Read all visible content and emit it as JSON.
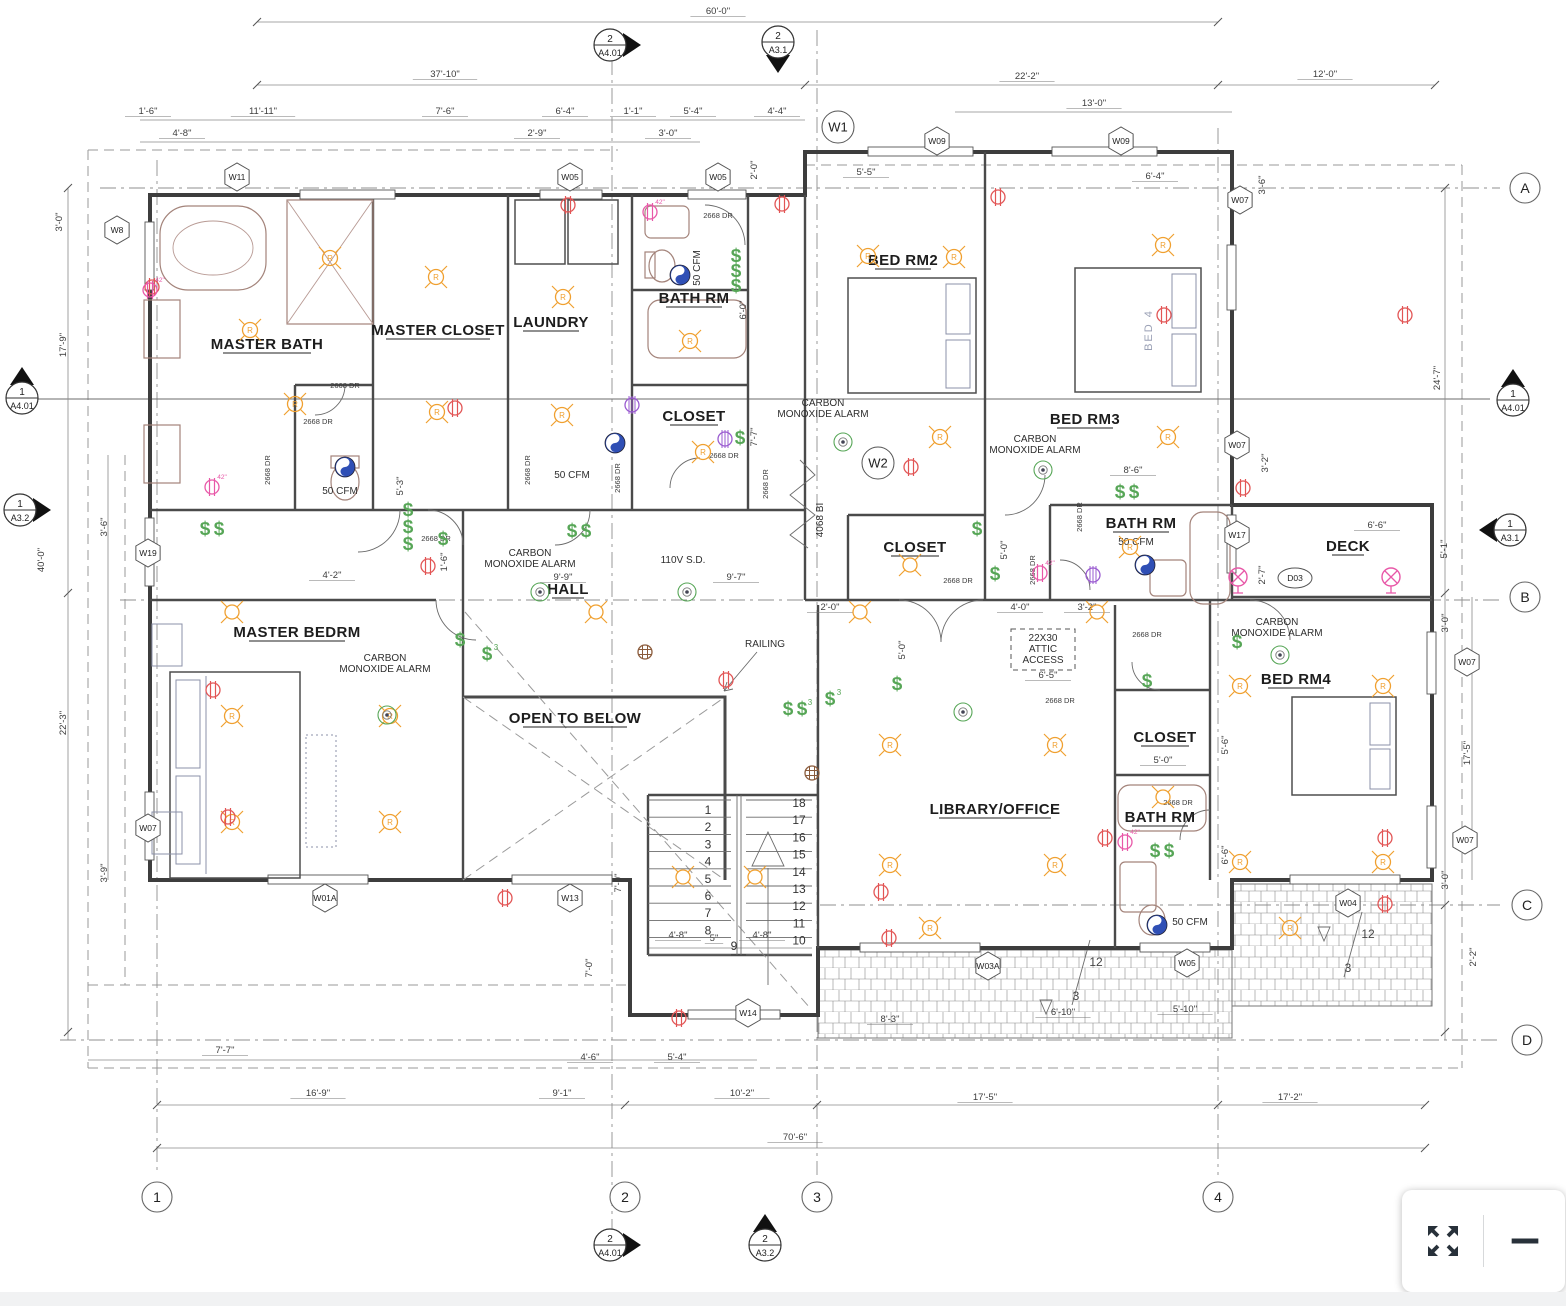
{
  "toolbar": {
    "fullscreen_label": "fullscreen",
    "zoom_out_label": "zoom out"
  },
  "plan": {
    "rooms": [
      {
        "label": "MASTER BATH",
        "x": 267,
        "y": 349
      },
      {
        "label": "MASTER CLOSET",
        "x": 438,
        "y": 335
      },
      {
        "label": "LAUNDRY",
        "x": 551,
        "y": 327
      },
      {
        "label": "BATH RM",
        "x": 694,
        "y": 303
      },
      {
        "label": "BED RM2",
        "x": 903,
        "y": 265
      },
      {
        "label": "BED RM3",
        "x": 1085,
        "y": 424
      },
      {
        "label": "CLOSET",
        "x": 694,
        "y": 421
      },
      {
        "label": "CLOSET",
        "x": 915,
        "y": 552
      },
      {
        "label": "BATH RM",
        "x": 1141,
        "y": 528
      },
      {
        "label": "DECK",
        "x": 1348,
        "y": 551
      },
      {
        "label": "HALL",
        "x": 568,
        "y": 594
      },
      {
        "label": "MASTER BEDRM",
        "x": 297,
        "y": 637
      },
      {
        "label": "OPEN TO BELOW",
        "x": 575,
        "y": 723
      },
      {
        "label": "LIBRARY/OFFICE",
        "x": 995,
        "y": 814
      },
      {
        "label": "CLOSET",
        "x": 1165,
        "y": 742
      },
      {
        "label": "BATH RM",
        "x": 1160,
        "y": 822
      },
      {
        "label": "BED RM4",
        "x": 1296,
        "y": 684
      }
    ],
    "annotations": [
      {
        "t": "CARBON|MONOXIDE ALARM",
        "x": 530,
        "y": 556
      },
      {
        "t": "CARBON|MONOXIDE ALARM",
        "x": 385,
        "y": 661
      },
      {
        "t": "CARBON|MONOXIDE ALARM",
        "x": 823,
        "y": 406
      },
      {
        "t": "CARBON|MONOXIDE ALARM",
        "x": 1035,
        "y": 442
      },
      {
        "t": "CARBON|MONOXIDE ALARM",
        "x": 1277,
        "y": 625
      },
      {
        "t": "110V S.D.",
        "x": 683,
        "y": 563
      },
      {
        "t": "RAILING",
        "x": 765,
        "y": 647
      },
      {
        "t": "22X30|ATTIC|ACCESS",
        "x": 1043,
        "y": 641,
        "box": 1
      },
      {
        "t": "50 CFM",
        "x": 340,
        "y": 494
      },
      {
        "t": "50 CFM",
        "x": 572,
        "y": 478
      },
      {
        "t": "50 CFM",
        "x": 700,
        "y": 268,
        "r": 1
      },
      {
        "t": "50 CFM",
        "x": 1136,
        "y": 545
      },
      {
        "t": "50 CFM",
        "x": 1190,
        "y": 925
      },
      {
        "t": "4068 BI",
        "x": 823,
        "y": 520,
        "r": 1
      },
      {
        "t": "BED 4",
        "x": 1152,
        "y": 330,
        "r": 1,
        "gray": 1
      },
      {
        "t": "12",
        "x": 1096,
        "y": 966,
        "slope": 1
      },
      {
        "t": "3",
        "x": 1076,
        "y": 1000,
        "slope": 1
      },
      {
        "t": "12",
        "x": 1368,
        "y": 938,
        "slope": 1
      },
      {
        "t": "3",
        "x": 1348,
        "y": 972,
        "slope": 1
      }
    ],
    "door_labels": [
      {
        "t": "2668 DR",
        "x": 718,
        "y": 218
      },
      {
        "t": "2668 DR",
        "x": 345,
        "y": 388
      },
      {
        "t": "2668 DR",
        "x": 318,
        "y": 424
      },
      {
        "t": "2668 DR",
        "x": 436,
        "y": 541
      },
      {
        "t": "2668 DR",
        "x": 724,
        "y": 458
      },
      {
        "t": "2668 DR",
        "x": 958,
        "y": 583
      },
      {
        "t": "2668 DR",
        "x": 1147,
        "y": 637
      },
      {
        "t": "2668 DR",
        "x": 1060,
        "y": 703
      },
      {
        "t": "2668 DR",
        "x": 1178,
        "y": 805
      },
      {
        "t": "2668 DR",
        "x": 530,
        "y": 470,
        "r": 1
      },
      {
        "t": "2668 DR",
        "x": 620,
        "y": 478,
        "r": 1
      },
      {
        "t": "2668 DR",
        "x": 768,
        "y": 484,
        "r": 1
      },
      {
        "t": "2668 DR",
        "x": 1035,
        "y": 570,
        "r": 1
      },
      {
        "t": "2668 DR",
        "x": 1082,
        "y": 517,
        "r": 1
      },
      {
        "t": "2668 DR",
        "x": 270,
        "y": 470,
        "r": 1
      }
    ],
    "dimensions": [
      {
        "t": "60'-0\"",
        "x": 718,
        "y": 14
      },
      {
        "t": "37'-10\"",
        "x": 445,
        "y": 77
      },
      {
        "t": "22'-2\"",
        "x": 1027,
        "y": 79
      },
      {
        "t": "12'-0\"",
        "x": 1325,
        "y": 77
      },
      {
        "t": "13'-0\"",
        "x": 1094,
        "y": 106
      },
      {
        "t": "1'-6\"",
        "x": 148,
        "y": 114
      },
      {
        "t": "11'-11\"",
        "x": 263,
        "y": 114
      },
      {
        "t": "7'-6\"",
        "x": 445,
        "y": 114
      },
      {
        "t": "6'-4\"",
        "x": 565,
        "y": 114
      },
      {
        "t": "1'-1\"",
        "x": 633,
        "y": 114
      },
      {
        "t": "5'-4\"",
        "x": 693,
        "y": 114
      },
      {
        "t": "4'-4\"",
        "x": 777,
        "y": 114
      },
      {
        "t": "4'-8\"",
        "x": 182,
        "y": 136
      },
      {
        "t": "2'-9\"",
        "x": 537,
        "y": 136
      },
      {
        "t": "3'-0\"",
        "x": 668,
        "y": 136
      },
      {
        "t": "2'-0\"",
        "x": 757,
        "y": 170,
        "r": 1
      },
      {
        "t": "5'-5\"",
        "x": 866,
        "y": 175
      },
      {
        "t": "6'-4\"",
        "x": 1155,
        "y": 179
      },
      {
        "t": "3'-6\"",
        "x": 1265,
        "y": 185,
        "r": 1
      },
      {
        "t": "3'-0\"",
        "x": 62,
        "y": 222,
        "r": 1
      },
      {
        "t": "17'-9\"",
        "x": 66,
        "y": 345,
        "r": 1
      },
      {
        "t": "40'-0\"",
        "x": 44,
        "y": 560,
        "r": 1
      },
      {
        "t": "3'-6\"",
        "x": 107,
        "y": 527,
        "r": 1
      },
      {
        "t": "22'-3\"",
        "x": 66,
        "y": 723,
        "r": 1
      },
      {
        "t": "3'-9\"",
        "x": 107,
        "y": 873,
        "r": 1
      },
      {
        "t": "24'-7\"",
        "x": 1440,
        "y": 378,
        "r": 1
      },
      {
        "t": "5'-1\"",
        "x": 1447,
        "y": 549,
        "r": 1
      },
      {
        "t": "3'-0\"",
        "x": 1448,
        "y": 623,
        "r": 1
      },
      {
        "t": "17'-5\"",
        "x": 1470,
        "y": 753,
        "r": 1
      },
      {
        "t": "3'-0\"",
        "x": 1448,
        "y": 880,
        "r": 1
      },
      {
        "t": "2'-2\"",
        "x": 1476,
        "y": 957,
        "r": 1
      },
      {
        "t": "3'-2\"",
        "x": 1268,
        "y": 463,
        "r": 1
      },
      {
        "t": "6'-0\"",
        "x": 746,
        "y": 310,
        "r": 1
      },
      {
        "t": "7'-7\"",
        "x": 757,
        "y": 437,
        "r": 1
      },
      {
        "t": "8'-6\"",
        "x": 1133,
        "y": 473
      },
      {
        "t": "5'-0\"",
        "x": 1007,
        "y": 550,
        "r": 1
      },
      {
        "t": "5'-3\"",
        "x": 403,
        "y": 486,
        "r": 1
      },
      {
        "t": "4'-2\"",
        "x": 332,
        "y": 578
      },
      {
        "t": "9'-9\"",
        "x": 563,
        "y": 580
      },
      {
        "t": "9'-7\"",
        "x": 736,
        "y": 580
      },
      {
        "t": "1'-6\"",
        "x": 447,
        "y": 562,
        "r": 1
      },
      {
        "t": "2'-0\"",
        "x": 830,
        "y": 610
      },
      {
        "t": "4'-0\"",
        "x": 1020,
        "y": 610
      },
      {
        "t": "3'-2\"",
        "x": 1087,
        "y": 610
      },
      {
        "t": "5'-0\"",
        "x": 905,
        "y": 650,
        "r": 1
      },
      {
        "t": "6'-5\"",
        "x": 1048,
        "y": 678
      },
      {
        "t": "5'-0\"",
        "x": 1163,
        "y": 763
      },
      {
        "t": "5'-6\"",
        "x": 1228,
        "y": 745,
        "r": 1
      },
      {
        "t": "6'-6\"",
        "x": 1228,
        "y": 855,
        "r": 1
      },
      {
        "t": "6'-6\"",
        "x": 1377,
        "y": 528
      },
      {
        "t": "2'-7\"",
        "x": 1265,
        "y": 575,
        "r": 1
      },
      {
        "t": "4'-8\"",
        "x": 678,
        "y": 938
      },
      {
        "t": "5\"",
        "x": 714,
        "y": 941
      },
      {
        "t": "4'-8\"",
        "x": 762,
        "y": 938
      },
      {
        "t": "7'-0\"",
        "x": 621,
        "y": 883,
        "r": 1
      },
      {
        "t": "7'-0\"",
        "x": 592,
        "y": 968,
        "r": 1
      },
      {
        "t": "7'-7\"",
        "x": 225,
        "y": 1053
      },
      {
        "t": "4'-6\"",
        "x": 590,
        "y": 1060
      },
      {
        "t": "5'-4\"",
        "x": 677,
        "y": 1060
      },
      {
        "t": "8'-3\"",
        "x": 890,
        "y": 1022
      },
      {
        "t": "6'-10\"",
        "x": 1063,
        "y": 1015
      },
      {
        "t": "5'-10\"",
        "x": 1185,
        "y": 1012
      },
      {
        "t": "16'-9\"",
        "x": 318,
        "y": 1096
      },
      {
        "t": "9'-1\"",
        "x": 562,
        "y": 1096
      },
      {
        "t": "10'-2\"",
        "x": 742,
        "y": 1096
      },
      {
        "t": "17'-5\"",
        "x": 985,
        "y": 1100
      },
      {
        "t": "17'-2\"",
        "x": 1290,
        "y": 1100
      },
      {
        "t": "70'-6\"",
        "x": 795,
        "y": 1140
      }
    ],
    "window_tags": [
      {
        "label": "W11",
        "x": 237,
        "y": 177
      },
      {
        "label": "W05",
        "x": 570,
        "y": 177
      },
      {
        "label": "W05",
        "x": 718,
        "y": 177
      },
      {
        "label": "W8",
        "x": 117,
        "y": 230
      },
      {
        "label": "W09",
        "x": 937,
        "y": 141
      },
      {
        "label": "W09",
        "x": 1121,
        "y": 141
      },
      {
        "label": "W07",
        "x": 1240,
        "y": 200
      },
      {
        "label": "W19",
        "x": 148,
        "y": 553
      },
      {
        "label": "W07",
        "x": 1237,
        "y": 445
      },
      {
        "label": "W17",
        "x": 1237,
        "y": 535
      },
      {
        "label": "W07",
        "x": 1467,
        "y": 662
      },
      {
        "label": "W07",
        "x": 1465,
        "y": 840
      },
      {
        "label": "W04",
        "x": 1348,
        "y": 903
      },
      {
        "label": "W03A",
        "x": 988,
        "y": 966
      },
      {
        "label": "W05",
        "x": 1187,
        "y": 963
      },
      {
        "label": "W01A",
        "x": 325,
        "y": 898
      },
      {
        "label": "W13",
        "x": 570,
        "y": 898
      },
      {
        "label": "W14",
        "x": 748,
        "y": 1013
      },
      {
        "label": "W07",
        "x": 148,
        "y": 828
      },
      {
        "label": "W1",
        "x": 838,
        "y": 127,
        "shape": "circle"
      },
      {
        "label": "W2",
        "x": 878,
        "y": 463,
        "shape": "circle"
      },
      {
        "label": "D03",
        "x": 1295,
        "y": 578,
        "shape": "oval"
      }
    ],
    "grid_bubbles": [
      {
        "label": "1",
        "x": 157,
        "y": 1197
      },
      {
        "label": "2",
        "x": 625,
        "y": 1197
      },
      {
        "label": "3",
        "x": 817,
        "y": 1197
      },
      {
        "label": "4",
        "x": 1218,
        "y": 1197
      },
      {
        "label": "A",
        "x": 1525,
        "y": 188
      },
      {
        "label": "B",
        "x": 1525,
        "y": 597
      },
      {
        "label": "C",
        "x": 1527,
        "y": 905
      },
      {
        "label": "D",
        "x": 1527,
        "y": 1040
      }
    ],
    "section_markers": [
      {
        "num": "2",
        "sheet": "A4.01",
        "x": 610,
        "y": 45,
        "dir": "right"
      },
      {
        "num": "2",
        "sheet": "A3.1",
        "x": 778,
        "y": 42,
        "dir": "down"
      },
      {
        "num": "1",
        "sheet": "A4.01",
        "x": 22,
        "y": 398,
        "dir": "up"
      },
      {
        "num": "1",
        "sheet": "A3.2",
        "x": 20,
        "y": 510,
        "dir": "right"
      },
      {
        "num": "1",
        "sheet": "A4.01",
        "x": 1513,
        "y": 400,
        "dir": "up"
      },
      {
        "num": "1",
        "sheet": "A3.1",
        "x": 1510,
        "y": 530,
        "dir": "left"
      },
      {
        "num": "2",
        "sheet": "A4.01",
        "x": 610,
        "y": 1245,
        "dir": "right"
      },
      {
        "num": "2",
        "sheet": "A3.2",
        "x": 765,
        "y": 1245,
        "dir": "up"
      }
    ],
    "stairs": {
      "left": [
        "1",
        "2",
        "3",
        "4",
        "5",
        "6",
        "7",
        "8"
      ],
      "right": [
        "18",
        "17",
        "16",
        "15",
        "14",
        "13",
        "12",
        "11",
        "10"
      ],
      "mid": "9"
    },
    "symbols": {
      "recessed": [
        [
          330,
          258
        ],
        [
          250,
          330
        ],
        [
          295,
          404
        ],
        [
          436,
          277
        ],
        [
          437,
          412
        ],
        [
          563,
          297
        ],
        [
          562,
          415
        ],
        [
          690,
          341
        ],
        [
          703,
          452
        ],
        [
          868,
          256
        ],
        [
          954,
          257
        ],
        [
          1163,
          245
        ],
        [
          940,
          437
        ],
        [
          1168,
          437
        ],
        [
          1130,
          547
        ],
        [
          232,
          716
        ],
        [
          232,
          822
        ],
        [
          390,
          716
        ],
        [
          390,
          822
        ],
        [
          890,
          745
        ],
        [
          1055,
          745
        ],
        [
          890,
          865
        ],
        [
          1055,
          865
        ],
        [
          930,
          928
        ],
        [
          1290,
          928
        ],
        [
          1240,
          686
        ],
        [
          1383,
          686
        ],
        [
          1240,
          862
        ],
        [
          1383,
          862
        ]
      ],
      "lights": [
        [
          232,
          612
        ],
        [
          596,
          612
        ],
        [
          860,
          612
        ],
        [
          1097,
          612
        ],
        [
          683,
          877
        ],
        [
          755,
          877
        ],
        [
          910,
          565
        ],
        [
          1163,
          797
        ]
      ],
      "outlets": [
        [
          152,
          287
        ],
        [
          568,
          205
        ],
        [
          782,
          204
        ],
        [
          998,
          197
        ],
        [
          1164,
          315
        ],
        [
          1405,
          315
        ],
        [
          428,
          566
        ],
        [
          726,
          680
        ],
        [
          881,
          892
        ],
        [
          455,
          408
        ],
        [
          213,
          690
        ],
        [
          228,
          817
        ],
        [
          505,
          898
        ],
        [
          911,
          467
        ],
        [
          1243,
          488
        ],
        [
          1385,
          838
        ],
        [
          1105,
          838
        ],
        [
          679,
          1018
        ],
        [
          889,
          938
        ],
        [
          1385,
          904
        ]
      ],
      "outlets42": [
        [
          150,
          290
        ],
        [
          212,
          487
        ],
        [
          650,
          212
        ],
        [
          1125,
          842
        ],
        [
          1040,
          573
        ]
      ],
      "switches": [
        {
          "t": "$$",
          "x": 205,
          "y": 535
        },
        {
          "t": "$",
          "x": 408,
          "y": 516
        },
        {
          "t": "$",
          "x": 408,
          "y": 533
        },
        {
          "t": "$",
          "x": 408,
          "y": 550
        },
        {
          "t": "$",
          "x": 443,
          "y": 545
        },
        {
          "t": "$",
          "x": 740,
          "y": 444
        },
        {
          "t": "$$",
          "x": 572,
          "y": 537
        },
        {
          "t": "$",
          "x": 460,
          "y": 646
        },
        {
          "t": "$3",
          "x": 487,
          "y": 660
        },
        {
          "t": "$$3",
          "x": 788,
          "y": 715
        },
        {
          "t": "$",
          "x": 736,
          "y": 262
        },
        {
          "t": "$",
          "x": 736,
          "y": 277
        },
        {
          "t": "$",
          "x": 736,
          "y": 292
        },
        {
          "t": "$$",
          "x": 1120,
          "y": 498
        },
        {
          "t": "$",
          "x": 977,
          "y": 535
        },
        {
          "t": "$",
          "x": 995,
          "y": 580
        },
        {
          "t": "$3",
          "x": 830,
          "y": 705
        },
        {
          "t": "$",
          "x": 897,
          "y": 690
        },
        {
          "t": "$",
          "x": 1147,
          "y": 687
        },
        {
          "t": "$$",
          "x": 1155,
          "y": 857
        },
        {
          "t": "$",
          "x": 1237,
          "y": 648
        }
      ],
      "detectors": [
        [
          540,
          592
        ],
        [
          387,
          715
        ],
        [
          843,
          442
        ],
        [
          1043,
          470
        ],
        [
          1280,
          655
        ],
        [
          963,
          712
        ],
        [
          687,
          592
        ]
      ],
      "fans": [
        [
          345,
          467
        ],
        [
          615,
          443
        ],
        [
          680,
          275
        ],
        [
          1145,
          565
        ],
        [
          1157,
          925
        ]
      ],
      "deck_lights": [
        [
          1238,
          577
        ],
        [
          1391,
          577
        ]
      ],
      "purple": [
        [
          632,
          405
        ],
        [
          725,
          439
        ],
        [
          1093,
          575
        ]
      ],
      "junction": [
        [
          645,
          652
        ],
        [
          812,
          773
        ]
      ]
    }
  }
}
